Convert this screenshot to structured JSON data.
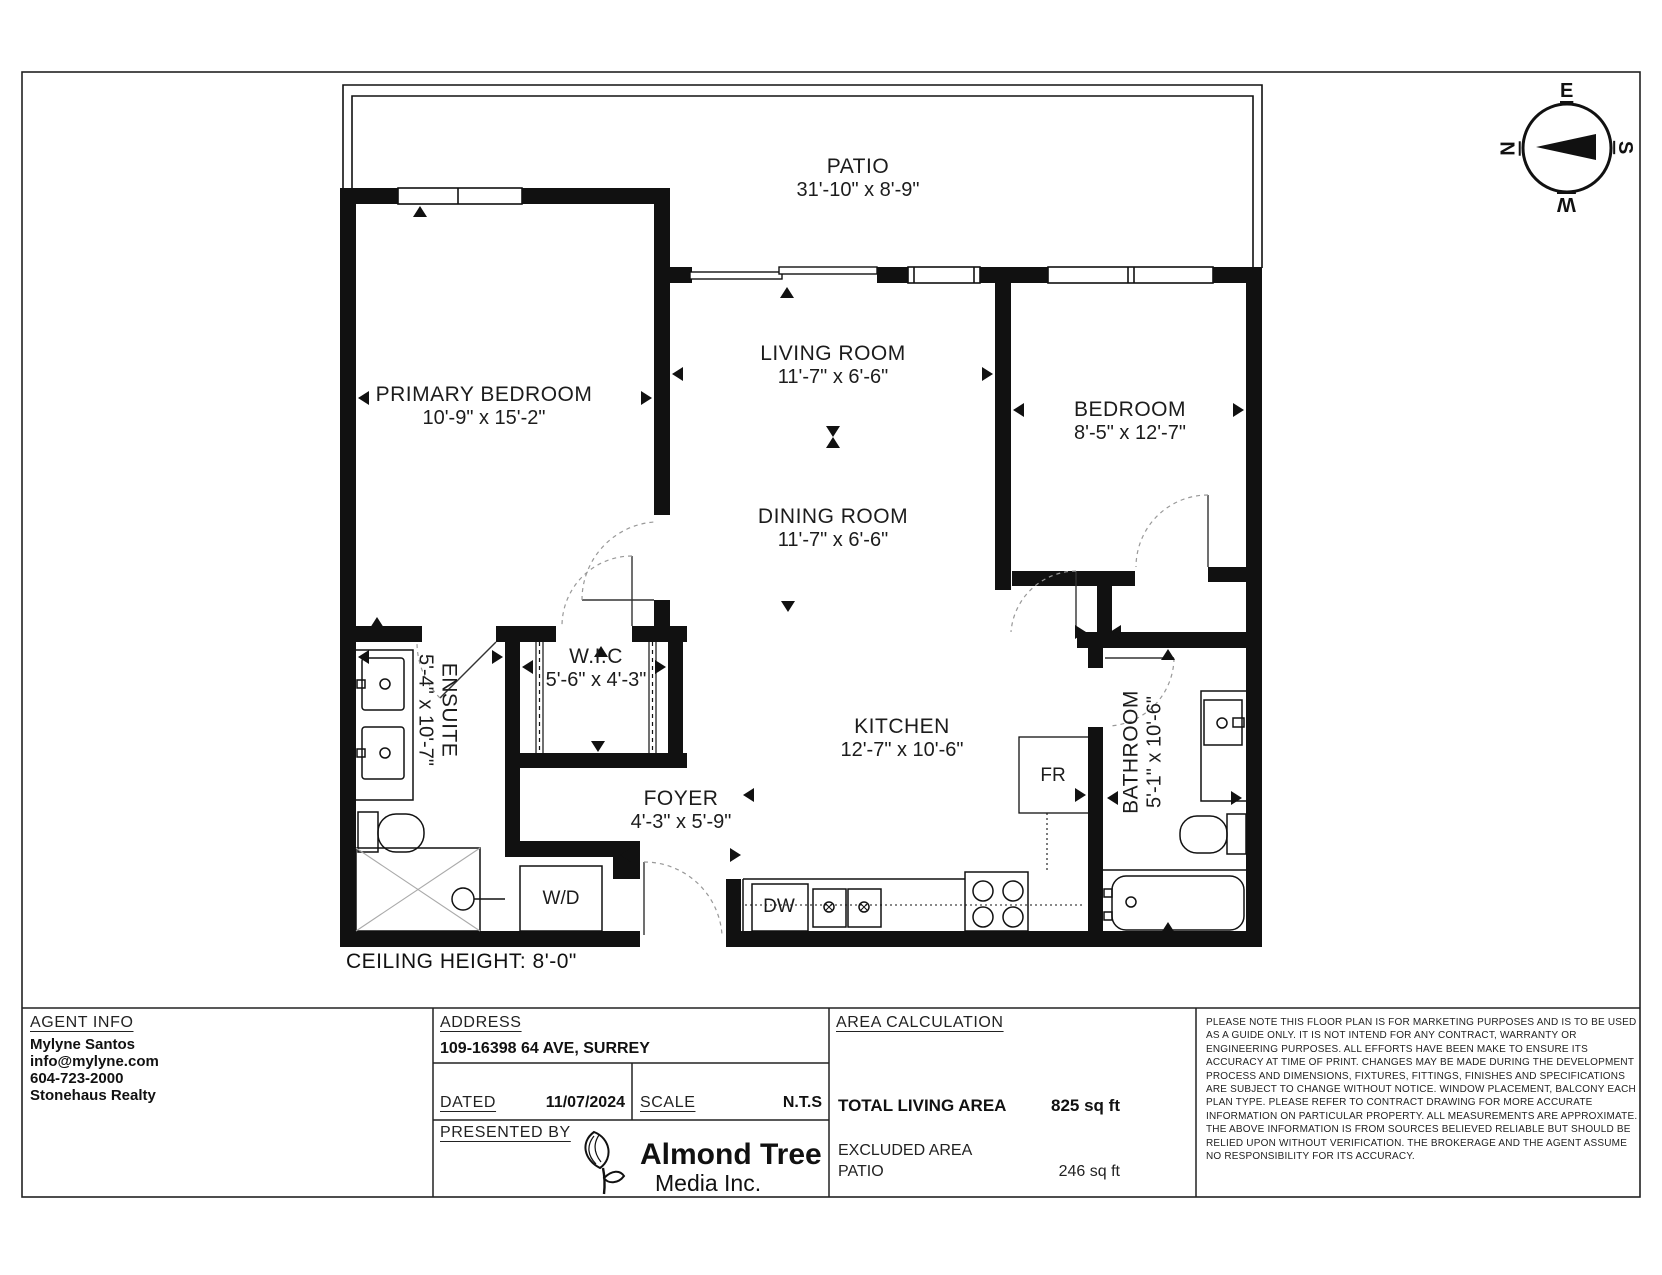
{
  "plan": {
    "ceiling_note": "CEILING HEIGHT: 8'-0\"",
    "patio": {
      "name": "PATIO",
      "dims": "31'-10\" x 8'-9\""
    },
    "rooms": [
      {
        "name": "PRIMARY BEDROOM",
        "dims": "10'-9\" x 15'-2\""
      },
      {
        "name": "LIVING ROOM",
        "dims": "11'-7\" x 6'-6\""
      },
      {
        "name": "DINING ROOM",
        "dims": "11'-7\" x 6'-6\""
      },
      {
        "name": "BEDROOM",
        "dims": "8'-5\" x 12'-7\""
      },
      {
        "name": "W.I.C",
        "dims": "5'-6\" x 4'-3\""
      },
      {
        "name": "ENSUITE",
        "dims": "5'-4\" x 10'-7\""
      },
      {
        "name": "KITCHEN",
        "dims": "12'-7\" x 10'-6\""
      },
      {
        "name": "FOYER",
        "dims": "4'-3\" x 5'-9\""
      },
      {
        "name": "BATHROOM",
        "dims": "5'-1\" x 10'-6\""
      }
    ],
    "fixtures": {
      "fridge": "FR",
      "dishwasher": "DW",
      "washer_dryer": "W/D"
    },
    "compass": {
      "east": "E",
      "north": "N",
      "south": "S",
      "west": "W"
    }
  },
  "footer": {
    "agent": {
      "heading": "AGENT INFO",
      "name": "Mylyne Santos",
      "email": "info@mylyne.com",
      "phone": "604-723-2000",
      "brokerage": "Stonehaus Realty"
    },
    "address": {
      "heading": "ADDRESS",
      "value": "109-16398 64 AVE, SURREY"
    },
    "dated": {
      "label": "DATED",
      "value": "11/07/2024"
    },
    "scale": {
      "label": "SCALE",
      "value": "N.T.S"
    },
    "presented_by": {
      "label": "PRESENTED BY",
      "company_line1": "Almond Tree",
      "company_line2": "Media Inc."
    },
    "area": {
      "heading": "AREA CALCULATION",
      "total_label": "TOTAL LIVING AREA",
      "total_value": "825 sq ft",
      "excluded_label": "EXCLUDED AREA",
      "excluded_room": "PATIO",
      "excluded_value": "246 sq ft"
    },
    "disclaimer": "PLEASE NOTE THIS FLOOR PLAN IS FOR MARKETING PURPOSES AND IS TO BE USED AS A GUIDE ONLY. IT IS NOT INTEND FOR ANY CONTRACT, WARRANTY OR ENGINEERING PURPOSES. ALL EFFORTS HAVE BEEN MAKE TO ENSURE ITS ACCURACY AT TIME OF PRINT. CHANGES MAY BE MADE DURING THE DEVELOPMENT PROCESS AND DIMENSIONS, FIXTURES, FITTINGS, FINISHES AND SPECIFICATIONS ARE SUBJECT TO CHANGE WITHOUT NOTICE. WINDOW PLACEMENT, BALCONY EACH PLAN TYPE. PLEASE REFER TO CONTRACT DRAWING FOR MORE ACCURATE INFORMATION ON PARTICULAR PROPERTY. ALL MEASUREMENTS ARE APPROXIMATE. THE ABOVE INFORMATION IS FROM SOURCES BELIEVED RELIABLE BUT SHOULD BE RELIED UPON WITHOUT VERIFICATION. THE BROKERAGE AND THE AGENT ASSUME NO RESPONSIBILITY FOR ITS ACCURACY."
  }
}
